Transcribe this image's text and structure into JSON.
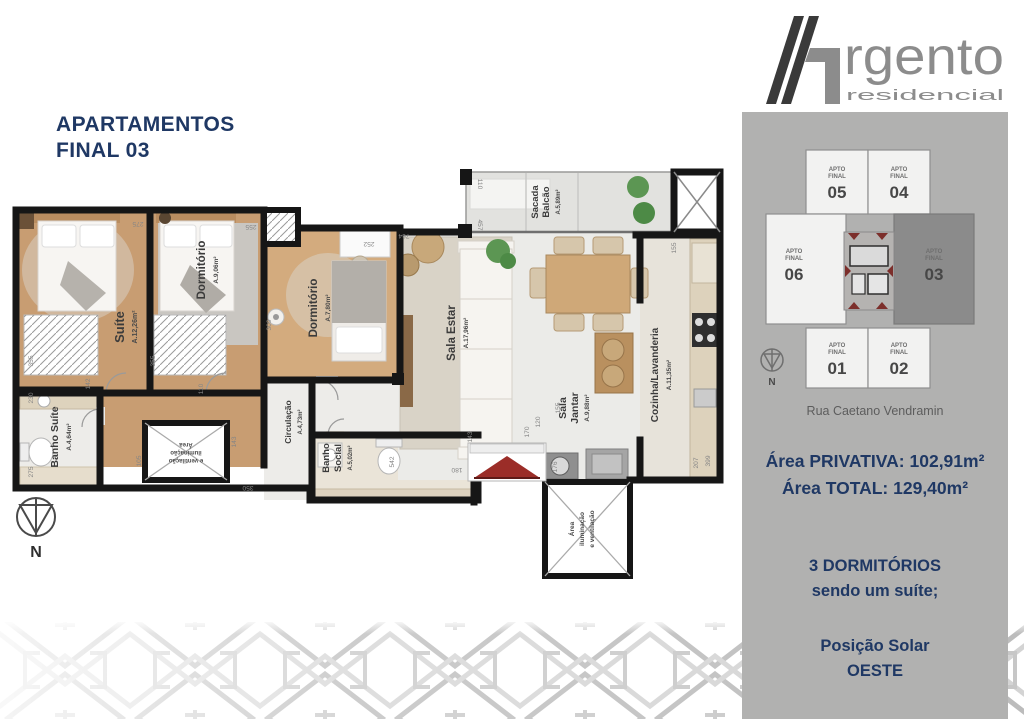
{
  "title": {
    "line1": "APARTAMENTOS",
    "line2": "FINAL 03"
  },
  "logo": {
    "brand": "rgento",
    "sub": "residencial"
  },
  "keyplan": {
    "apto": "APTO",
    "final": "FINAL",
    "units": [
      "05",
      "04",
      "06",
      "03",
      "01",
      "02"
    ],
    "highlighted_unit": "03",
    "street": "Rua Caetano Vendramin",
    "compass": "N"
  },
  "details": {
    "area_privativa": "Área PRIVATIVA: 102,91m²",
    "area_total": "Área TOTAL: 129,40m²",
    "dorms_line1": "3 DORMITÓRIOS",
    "dorms_line2": "sendo um suíte;",
    "solar_line1": "Posição Solar",
    "solar_line2": "OESTE"
  },
  "floorplan": {
    "compass": "N",
    "rooms": [
      {
        "name": "Suíte",
        "area": "A.12,26m²"
      },
      {
        "name": "Dormitório",
        "area": "A.9,06m²"
      },
      {
        "name": "Dormitório",
        "area": "A.7,80m²"
      },
      {
        "name": "Sala Estar",
        "area": "A.17,96m²"
      },
      {
        "name": "Sacada",
        "name2": "Balcão",
        "area": "A.5,89m²"
      },
      {
        "name": "Sala",
        "name2": "Jantar",
        "area": "A.9,88m²"
      },
      {
        "name": "Cozinha/Lavanderia",
        "area": "A.11,35m²"
      },
      {
        "name": "Banho Suíte",
        "area": "A.4,64m²"
      },
      {
        "name": "Banho",
        "name2": "Social",
        "area": "A.5,02m²"
      },
      {
        "name": "Circulação",
        "area": "A.4,73m²"
      },
      {
        "name": "Área",
        "name2": "iluminação",
        "name3": "e ventilação"
      }
    ],
    "dims": [
      "275",
      "255",
      "252",
      "764",
      "457",
      "110",
      "355",
      "230",
      "142",
      "275",
      "355",
      "110",
      "309",
      "105",
      "350",
      "143",
      "143",
      "542",
      "180",
      "170",
      "120",
      "176",
      "155",
      "155",
      "207",
      "399"
    ]
  },
  "colors": {
    "accent_navy": "#1f3864",
    "sidebar_gray": "#b1b1b0",
    "logo_gray": "#8c8c8c",
    "logo_dark": "#3a3a3a",
    "wall_black": "#161616",
    "wood_floor": "#c89d72",
    "tile_floor": "#ebebe8",
    "highlight_unit_gray": "#8b8b8b",
    "entry_arrow_red": "#9b2d28"
  }
}
